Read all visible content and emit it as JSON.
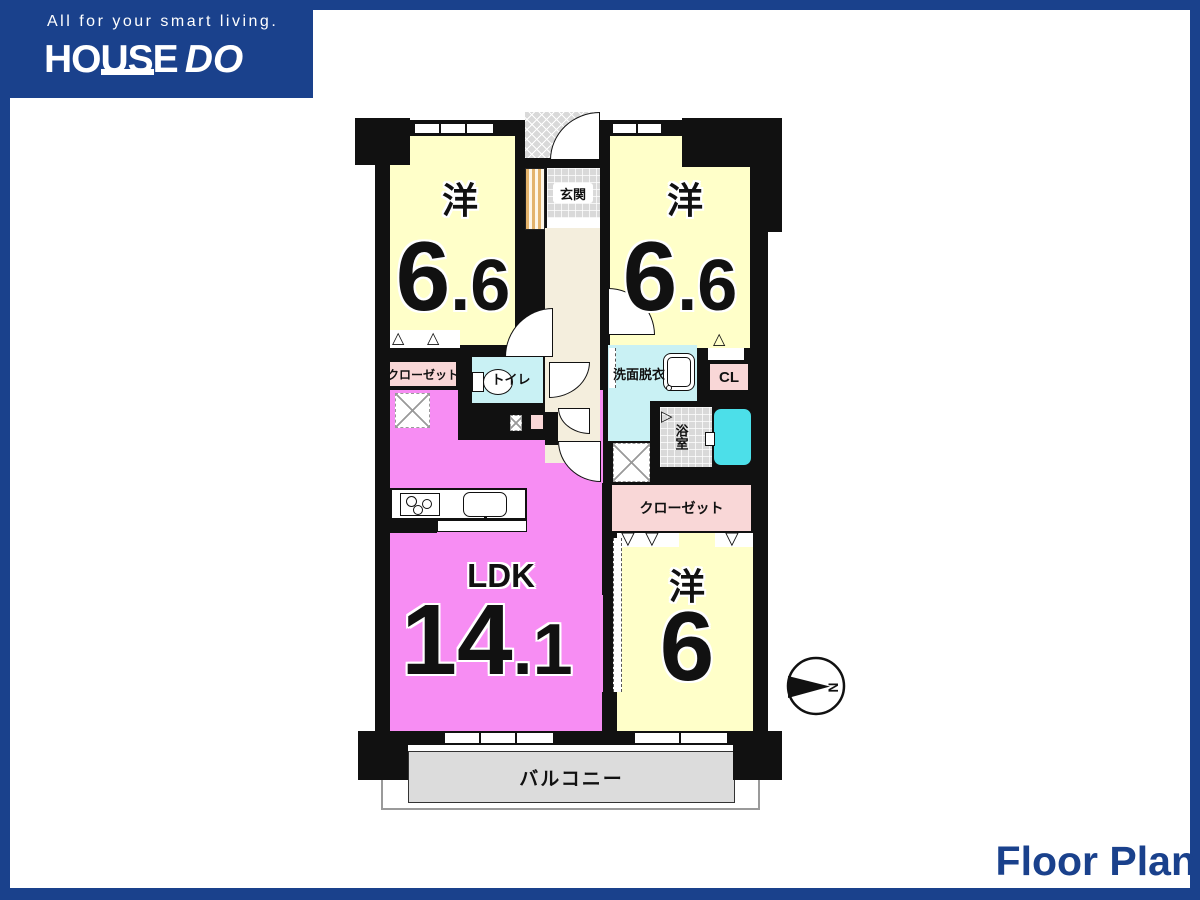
{
  "brand": {
    "tagline": "All for your smart living.",
    "logo_main": "HOUSE",
    "logo_accent": "DO"
  },
  "footer": {
    "title": "Floor Plan"
  },
  "compass": {
    "north": "N"
  },
  "icons": {
    "fold_up": "△",
    "fold_down": "▽",
    "bath_door": "▷"
  },
  "labels": {
    "ps": "PS",
    "entrance": "玄関",
    "toilet": "トイレ",
    "washroom": "洗面脱衣",
    "closet_upper": "クローゼット",
    "cl": "CL",
    "bath": "浴室",
    "closet_lower": "クローゼット",
    "balcony": "バルコニー"
  },
  "rooms": {
    "bedroom_left": {
      "name": "洋",
      "area_main": "6",
      "area_frac": ".6"
    },
    "bedroom_right": {
      "name": "洋",
      "area_main": "6",
      "area_frac": ".6"
    },
    "ldk": {
      "name": "LDK",
      "area_main": "14",
      "area_frac": ".1"
    },
    "bedroom_bottom": {
      "name": "洋",
      "area_main": "6",
      "area_frac": ""
    }
  },
  "colors": {
    "brand_blue": "#1a418c",
    "wall_black": "#111111",
    "room_yellow": "#ffffc9",
    "ldk_pink": "#f78df3",
    "closet_pink": "#f9d7d7",
    "water_cyan": "#c9f1f4",
    "tub_cyan": "#4cdfe9",
    "corridor_cream": "#f4eedd",
    "tile_grey": "#d9d9d9",
    "balcony_grey": "#dcdcdc"
  }
}
